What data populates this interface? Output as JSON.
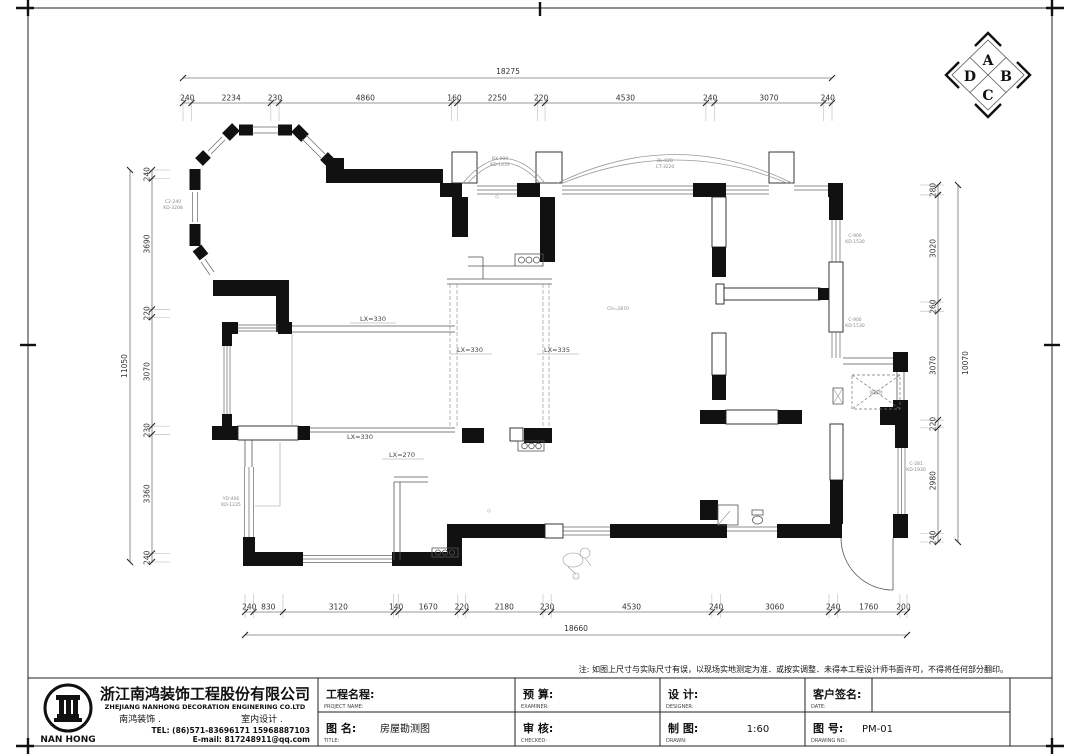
{
  "compass": {
    "top": "A",
    "right": "B",
    "bottom": "C",
    "left": "D"
  },
  "note": "注: 如图上尺寸与实际尺寸有误，以现场实地测定为准．或按实调整．未得本工程设计师书面许可，不得将任何部分翻印。",
  "company": {
    "logo_text": "NAN HONG",
    "name_cn": "浙江南鸿装饰工程股份有限公司",
    "name_en": "ZHEJIANG NANHONG DECORATION ENGINERING CO.LTD",
    "dept_left": "南鸿装饰 .",
    "dept_right": "室内设计 .",
    "tel": "TEL: (86)571-83696171 15968887103",
    "email": "E-mail: 817248911@qq.com"
  },
  "title_block": {
    "project_label_cn": "工程名程:",
    "project_label_en": "PROJECT NAME:",
    "title_label_cn": "图 名:",
    "title_label_en": "TITLE:",
    "title_value": "房屋勘测图",
    "budget_label_cn": "预  算:",
    "budget_label_en": "EXAMINER:",
    "check_label_cn": "审  核:",
    "check_label_en": "CHECKED:",
    "design_label_cn": "设  计:",
    "design_label_en": "DESIGNER:",
    "draw_label_cn": "制  图:",
    "draw_label_en": "DRAWN:",
    "scale_value": "1:60",
    "client_label_cn": "客户签名:",
    "client_label_en": "DATE:",
    "no_label_cn": "图  号:",
    "no_label_en": "DRAWING NO.:",
    "no_value": "PM-01"
  },
  "dims": {
    "top": {
      "overall": "18275",
      "segments": [
        240,
        2234,
        230,
        4860,
        160,
        2250,
        220,
        4530,
        240,
        3070,
        240
      ]
    },
    "bottom": {
      "overall": "18660",
      "segments": [
        240,
        830,
        3120,
        140,
        1670,
        220,
        2180,
        230,
        4530,
        240,
        3060,
        240,
        1760,
        200
      ]
    },
    "left": {
      "overall": "11050",
      "segments": [
        240,
        3690,
        220,
        3070,
        230,
        3360,
        240
      ]
    },
    "right": {
      "overall": "10070",
      "segments": [
        280,
        3020,
        260,
        3070,
        220,
        2980,
        240
      ]
    }
  },
  "plan": {
    "labels": [
      {
        "t": "LX=330"
      },
      {
        "t": "LX=330"
      },
      {
        "t": "LX=335"
      },
      {
        "t": "LX=330"
      },
      {
        "t": "LX=270"
      },
      {
        "t": "CH=2870"
      },
      {
        "t": "设备台"
      }
    ],
    "annotations": [
      {
        "l1": "C2-240",
        "l2": "KD-3208"
      },
      {
        "l1": "BX-900",
        "l2": "KD-1435"
      },
      {
        "l1": "BL-620",
        "l2": "CT-3220"
      },
      {
        "l1": "C-900",
        "l2": "KD-1530"
      },
      {
        "l1": "C-900",
        "l2": "KD-1530"
      },
      {
        "l1": "YD-406",
        "l2": "KD-1235"
      },
      {
        "l1": "C-281",
        "l2": "KD-1930"
      }
    ],
    "symbols": [
      {
        "t": "◇"
      },
      {
        "t": "◇"
      }
    ]
  }
}
